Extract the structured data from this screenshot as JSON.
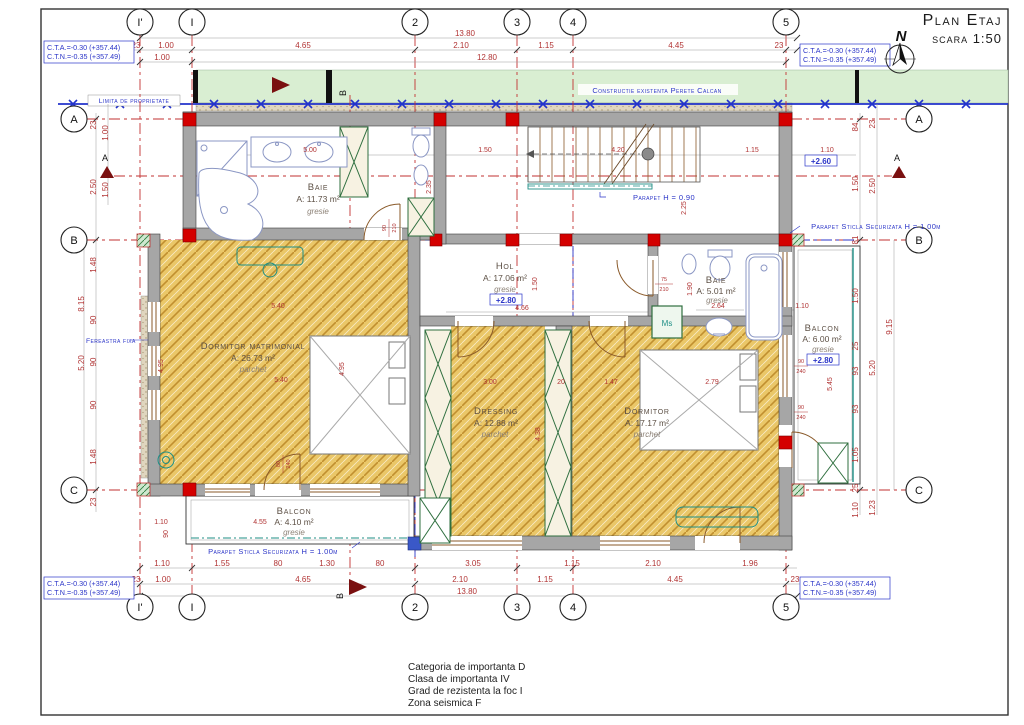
{
  "meta": {
    "title": "Plan Etaj",
    "scale": "scara 1:50",
    "north": "N"
  },
  "levels": {
    "cta": "C.T.A.=-0.30 (+357.44)",
    "ctn": "C.T.N.=-0.35 (+357.49)"
  },
  "grid": {
    "cols": [
      "I'",
      "I",
      "2",
      "3",
      "4",
      "5"
    ],
    "rows": [
      "A",
      "B",
      "C"
    ]
  },
  "notes": {
    "limita": "Limita de proprietate",
    "calcan": "Constructie existenta Perete Calcan",
    "parapet_stair": "Parapet H = 0.90",
    "parapet_glass_right": "Parapet Sticla Securizata H = 1.00m",
    "parapet_glass_bottom": "Parapet Sticla Securizata H = 1.00m",
    "fereastra_fixa": "Fereastra fixa",
    "ms": "Ms",
    "section_a": "A",
    "section_b": "B",
    "stair_level": "+2.60"
  },
  "rooms": {
    "baie1": {
      "name": "Baie",
      "area": "A: 11.73 m²",
      "finish": "gresie"
    },
    "hol": {
      "name": "Hol",
      "area": "A: 17.06 m²",
      "finish": "gresie",
      "level": "+2.80"
    },
    "baie2": {
      "name": "Baie",
      "area": "A: 5.01 m²",
      "finish": "gresie"
    },
    "dorm_mat": {
      "name": "Dormitor matrimonial",
      "area": "A: 26.73 m²",
      "finish": "parchet"
    },
    "dressing": {
      "name": "Dressing",
      "area": "A: 12.88 m²",
      "finish": "parchet"
    },
    "dormitor": {
      "name": "Dormitor",
      "area": "A: 17.17 m²",
      "finish": "parchet"
    },
    "balcon1": {
      "name": "Balcon",
      "area": "A: 4.10 m²",
      "finish": "gresie"
    },
    "balcon2": {
      "name": "Balcon",
      "area": "A: 6.00 m²",
      "finish": "gresie",
      "level": "+2.80"
    }
  },
  "dims": {
    "top1": [
      "23",
      "1.00",
      "4.65",
      "2.10",
      "1.15",
      "4.45",
      "23"
    ],
    "top_aux": {
      "d1380": "13.80",
      "d1280": "12.80",
      "d100": "1.00"
    },
    "bottom1": [
      "1.10",
      "1.55",
      "80",
      "1.30",
      "80",
      "3.05",
      "1.15",
      "2.10",
      "1.96"
    ],
    "bottom2": [
      "23",
      "1.00",
      "4.65",
      "2.10",
      "1.15",
      "4.45",
      "23"
    ],
    "bottom_aux": {
      "d1380": "13.80"
    },
    "left_mid": [
      "8.15",
      "5.20"
    ],
    "left_in": [
      "23",
      "2.50",
      "1.48",
      "90",
      "90",
      "90",
      "1.48",
      "23"
    ],
    "left_out": [
      "1.00",
      "1.50"
    ],
    "right_in": [
      "84",
      "1.50",
      "81",
      "1.50",
      "25",
      "93",
      "93",
      "1.05",
      "25",
      "1.10"
    ],
    "right_mid": [
      "23",
      "2.50",
      "5.20",
      "1.23"
    ],
    "right_out": [
      "9.15"
    ],
    "interior": {
      "d500": "5.00",
      "d150s": "1.50",
      "d420": "4.20",
      "d115s": "1.15",
      "d110s": "1.10",
      "d225": "2.25",
      "d235": "2.35",
      "d466": "4.66",
      "d150h": "1.50",
      "d264": "2.64",
      "d190": "1.90",
      "d540a": "5.40",
      "d540b": "5.40",
      "d495a": "4.95",
      "d495b": "4.95",
      "d300": "3.00",
      "d20": "20",
      "d147": "1.47",
      "d438": "4.38",
      "d279": "2.79",
      "d545": "5.45",
      "d110d": "1.10",
      "d455": "4.55",
      "d110b": "1.10",
      "d90b": "90"
    },
    "fractions": {
      "w90": "90",
      "w210": "210",
      "w75": "75",
      "w80": "80",
      "w240": "240"
    }
  },
  "footer": [
    "Categoria de importanta D",
    "Clasa de importanta IV",
    "Grad de rezistenta la foc I",
    "Zona seismica F"
  ]
}
